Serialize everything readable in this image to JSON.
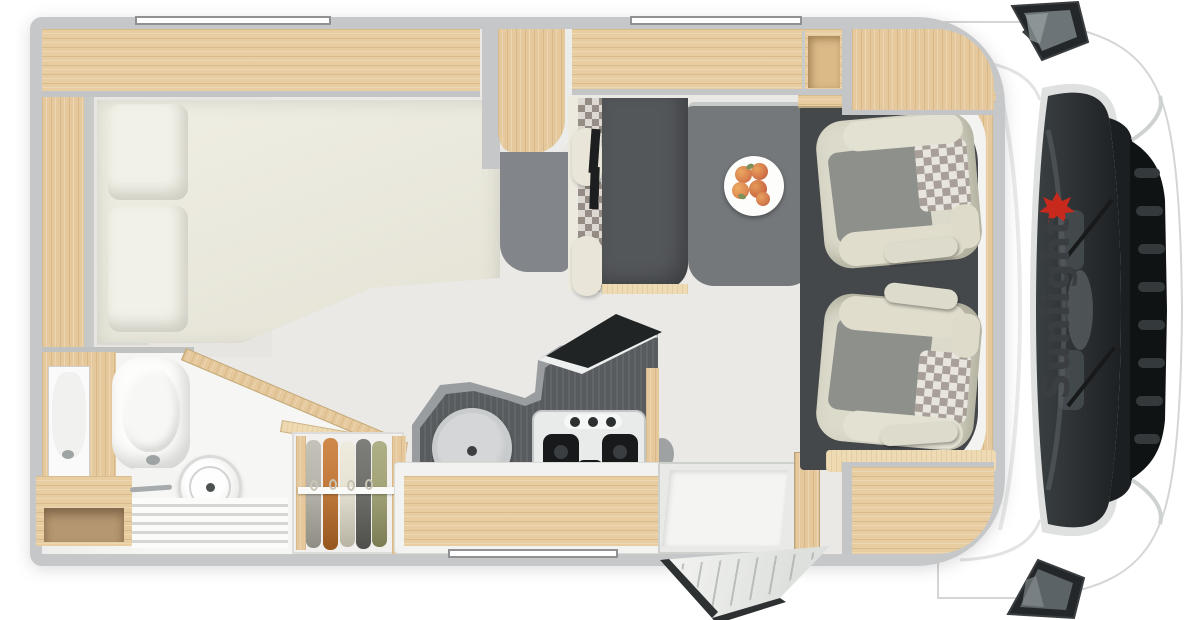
{
  "meta": {
    "title": "Motorhome floor plan (top view)",
    "view": "overhead cutaway",
    "vehicle_orientation": "cab on right, rear on left"
  },
  "branding": {
    "logo_text": "Sunlight",
    "logo_text_color": "#3b3e41",
    "logo_icon": "red-sun-icon",
    "logo_icon_color": "#c8291d",
    "logo_placement": "printed on cab hood, rotated 90°, reads bottom-to-top"
  },
  "palette": {
    "background": "#ffffff",
    "outer_wall": "#c5c7c9",
    "interior_base": "#eae9e6",
    "cabinet_wood": "#e7cda0",
    "floor_wood": "#97806f",
    "mattress_cream": "#ece9dc",
    "worktop_dark": "#595c5f",
    "worktop_rim": "#9a9da0",
    "table_gray": "#74787b",
    "seat_cream": "#dcdaca",
    "seat_gray": "#8e918b",
    "cab_platform": "#45484b",
    "windshield_dark": "#2c3032"
  },
  "areas": {
    "rear_bed": {
      "label": "Rear longitudinal bed",
      "parts": [
        "mattress with angled foot corner",
        "two pillows",
        "overhead lockers",
        "side wardrobe shelf"
      ]
    },
    "bathroom": {
      "label": "Washroom (rear left)",
      "parts": [
        "mirror",
        "cassette toilet",
        "round shower column",
        "vanity bench",
        "faucet",
        "slatted shower floor"
      ]
    },
    "wardrobe": {
      "label": "Hanging wardrobe",
      "clothes_colors": [
        "#b7b5ab",
        "#c1793c",
        "#e6e2d4",
        "#70716c",
        "#a3a478"
      ],
      "parts": [
        "clothes rail",
        "hangers"
      ]
    },
    "kitchen": {
      "label": "Kitchen block",
      "parts": [
        "round sink with drain",
        "3-burner gas hob",
        "control knobs",
        "flip-up glass lid (open)",
        "drawer unit with wooden front"
      ]
    },
    "dinette": {
      "label": "Half-dinette",
      "parts": [
        "travel bench with two 3-point seatbelts",
        "checkered backrest trim",
        "two cream headrest cushions",
        "pedestal table",
        "fruit plate with peaches"
      ]
    },
    "cab": {
      "label": "Driver cab",
      "parts": [
        "driver swivel seat",
        "passenger swivel seat",
        "checkered headrests",
        "armrests",
        "dark cab platform",
        "overhead lockers above cab"
      ]
    },
    "entrance": {
      "label": "Entrance door (shown open)",
      "parts": [
        "door leaf swung outward",
        "entry step well",
        "wooden door frame"
      ]
    },
    "vehicle_front": {
      "label": "Cab exterior",
      "parts": [
        "windshield",
        "wipers",
        "radiator grille",
        "left side mirror",
        "right side mirror",
        "hood with Sunlight logo"
      ]
    },
    "windows": {
      "label": "Wall windows / skylight strips",
      "count": 3,
      "positions": [
        "top wall rear",
        "top wall centre",
        "bottom wall centre"
      ]
    },
    "fruit_plate": {
      "label": "Plate with peaches",
      "item_count": 5
    }
  }
}
